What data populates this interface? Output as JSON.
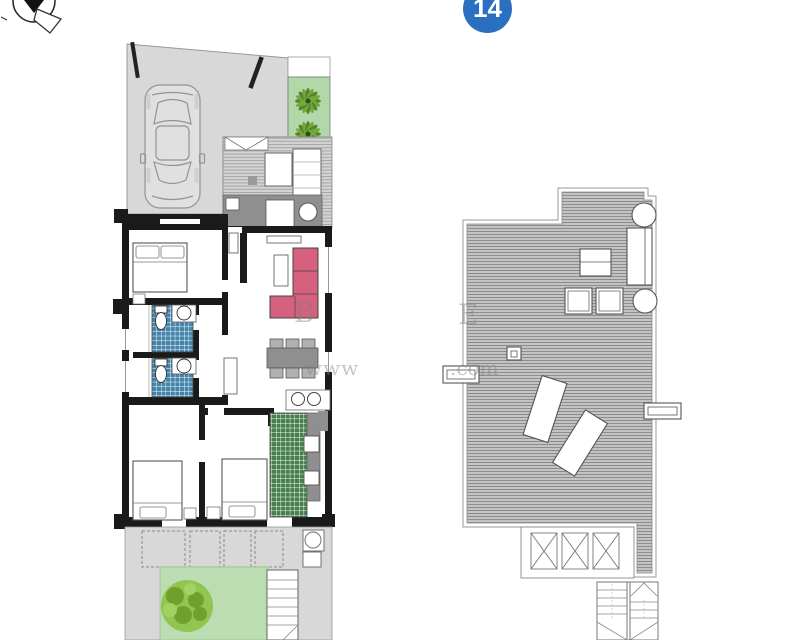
{
  "badge": {
    "number": "14",
    "color": "#2b6fc0"
  },
  "watermark": {
    "b": "B",
    "e": "E",
    "www": "www",
    "com": ".com"
  },
  "icons": {
    "compass": "compass-north-icon",
    "car": "car-top-view-icon",
    "palm": "palm-tree-icon",
    "bush": "garden-bush-icon"
  },
  "plan_colors": {
    "wall": "#1a1a1a",
    "paving": "#d8d8d8",
    "deck_base": "#d3d3d3",
    "deck_stripe": "#a6a6a6",
    "solarium_base": "#c3c3c3",
    "solarium_stripe": "#8d8d8d",
    "bath_tile": "#4584ab",
    "kitchen_tile": "#47804d",
    "lawn": "#bcdcb2",
    "bush": "#8cc34b",
    "bush_dark": "#6fa02e",
    "planter": "#b2d8aa",
    "palm_dark": "#55842e",
    "palm_light": "#74a83b",
    "sofa": "#d5617e",
    "dining_table": "#8f8f8f",
    "chair": "#b0b0b0",
    "counter": "#8f8f8f",
    "car_body": "#e0e0e0"
  }
}
